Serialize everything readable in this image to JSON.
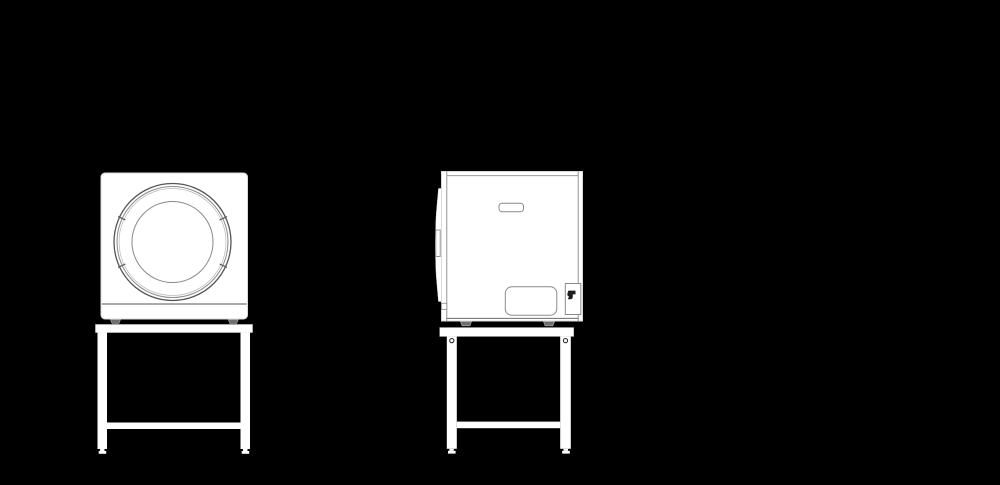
{
  "window": {
    "width": 1000,
    "height": 485
  },
  "colors": {
    "background": "#000000",
    "body-fill": "#ffffff",
    "silhouette-outline": "#d9d9d9",
    "detail-line": "#555555",
    "mid-line": "#8a8a8a",
    "light-line": "#b8b8b8",
    "dark-glyph": "#1d1d1d",
    "foot-fill": "#6e6e6e"
  },
  "figures": [
    {
      "name": "washing-machine-front-view-on-stand",
      "view": "front",
      "parts": [
        "machine-body",
        "porthole-door-outer-ring",
        "porthole-door-inner-ring",
        "door-glass",
        "door-ring-ticks",
        "plinth-line",
        "leveling-feet",
        "stand-top-rail",
        "stand-legs",
        "stand-crossbar",
        "stand-feet"
      ]
    },
    {
      "name": "washing-machine-side-view-on-stand",
      "view": "side",
      "parts": [
        "machine-body",
        "door-bulge",
        "door-side-handle",
        "top-trim-line",
        "front-panel-line",
        "back-panel-lines",
        "control-recess",
        "service-panel",
        "hose-hook-box",
        "hose-hook-glyph",
        "leveling-feet",
        "stand-top-rail",
        "stand-legs",
        "stand-bolt-holes",
        "stand-crossbar",
        "stand-feet"
      ]
    }
  ]
}
